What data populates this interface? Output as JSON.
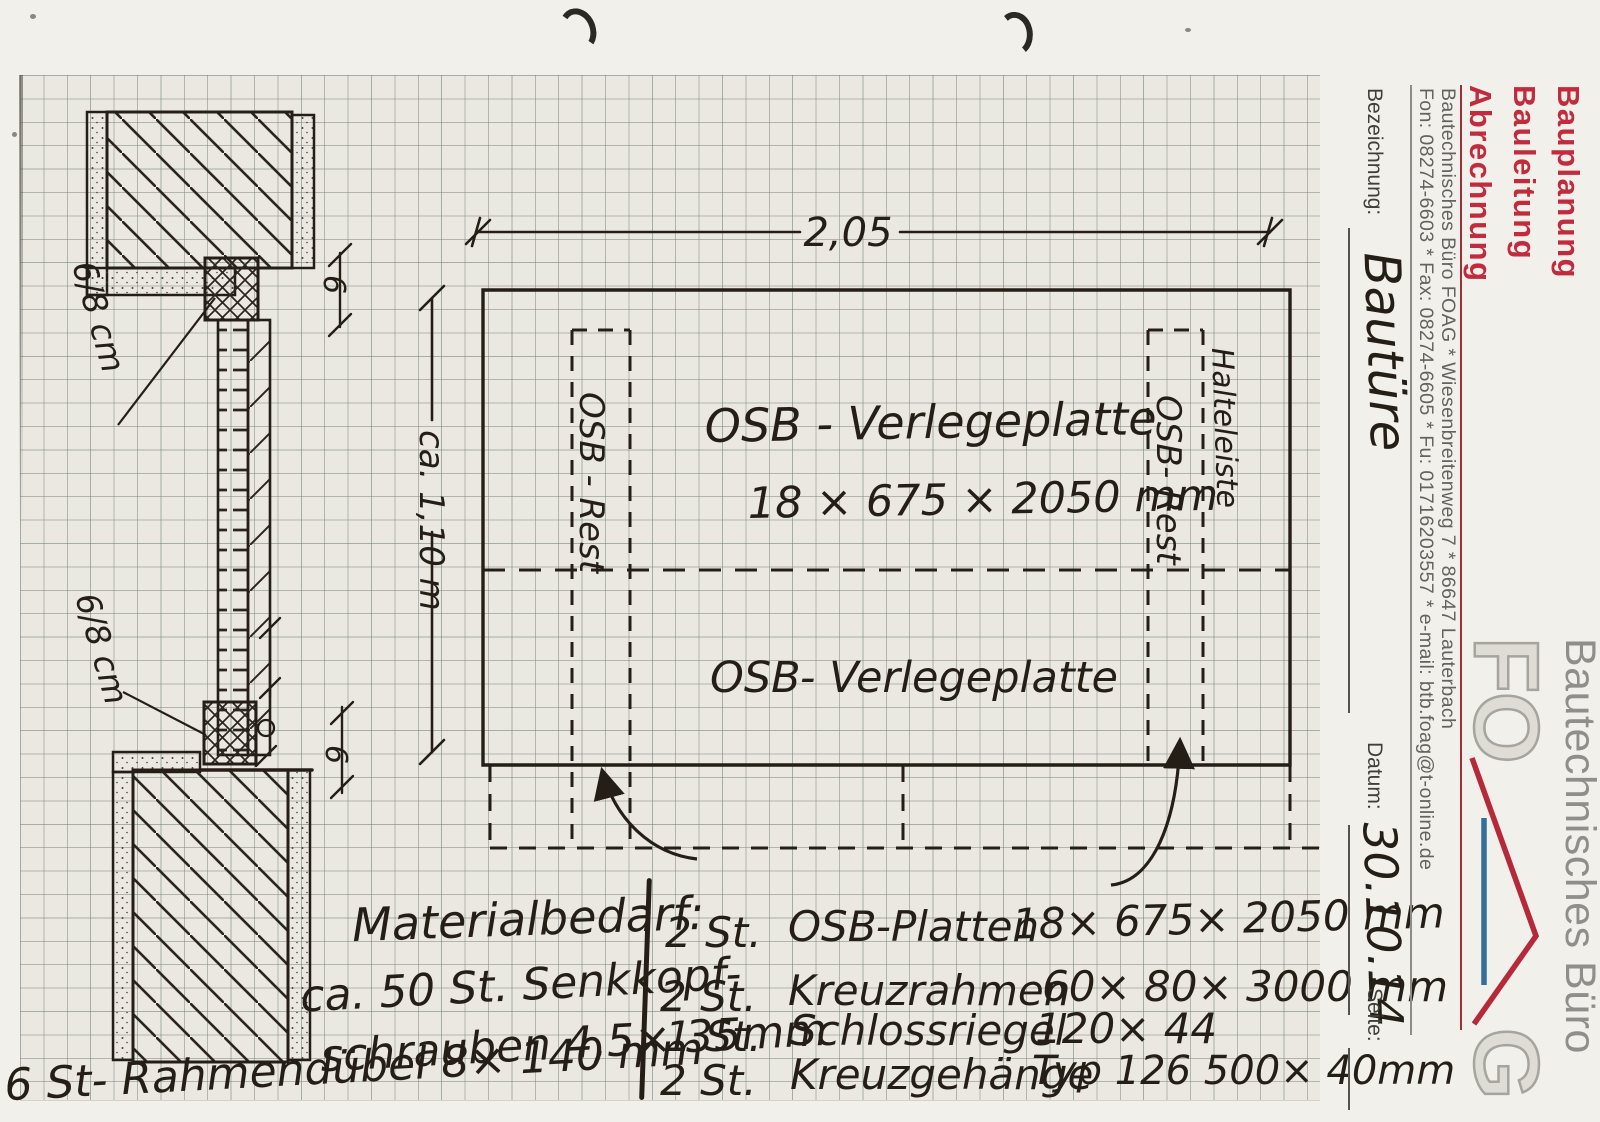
{
  "letterhead": {
    "services": [
      "Bauplanung",
      "Bauleitung",
      "Abrechnung"
    ],
    "firm_line": "Bautechnisches Büro FOAG  *  Wiesenbreitenweg 7  *  86647 Lauterbach",
    "contact_line": "Fon: 08274-6603  *  Fax: 08274-6605  *  Fu: 01716203557  *  e-mail: btb.foag@t-online.de",
    "fields": {
      "bezeichnung_label": "Bezeichnung:",
      "bezeichnung_value": "Bautüre",
      "datum_label": "Datum:",
      "datum_value": "30.10.14",
      "seite_label": "Seite:"
    },
    "logo": {
      "f": "F",
      "o": "O",
      "g": "G",
      "firm_name": "Bautechnisches Büro"
    },
    "colors": {
      "accent_red": "#c12b3d",
      "logo_blue": "#336f99",
      "logo_gray": "#a6a49e"
    }
  },
  "plan": {
    "width_dim": "2,05",
    "height_dim": "ca. 1,10 m",
    "plate_label": "OSB - Verlegeplatte",
    "plate_size": "18 × 675 × 2050 mm",
    "plate_label_2": "OSB-  Verlegeplatte",
    "rest_strip_left": "OSB - Rest",
    "rest_strip_right": "OSB- Rest",
    "halteleiste_label": "Halteleiste"
  },
  "section": {
    "timber_top": "6/8 cm",
    "timber_bottom": "6/8 cm",
    "gap_top": "6",
    "gap_bottom": "6"
  },
  "materials": {
    "heading": "Materialbedarf:",
    "items": [
      {
        "qty": "2 St.",
        "name": "OSB-Platten",
        "dims": "18× 675× 2050 mm"
      },
      {
        "qty": "2 St.",
        "name": "Kreuzrahmen",
        "dims": "60× 80× 3000 mm"
      },
      {
        "qty": "1 St.",
        "name": "Schlossriegel",
        "dims": "120× 44"
      },
      {
        "qty": "2 St.",
        "name": "Kreuzgehänge",
        "dims": "Typ 126  500× 40mm"
      }
    ],
    "notes": [
      "ca. 50 St. Senkkopf-",
      "schrauben  4,5× 35mm",
      "6 St- Rahmendübel   8× 140 mm"
    ]
  }
}
